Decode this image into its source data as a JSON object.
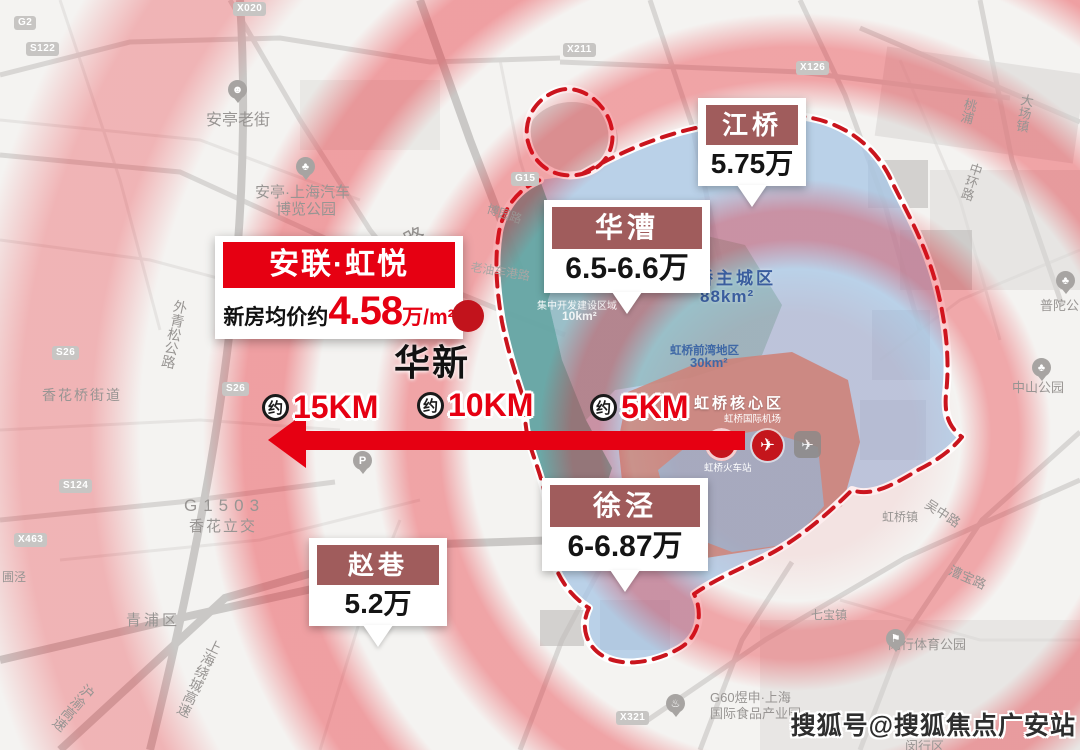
{
  "project_callout": {
    "name": "安联·虹悦",
    "price_prefix": "新房均价约",
    "price_value": "4.58",
    "price_unit": "万/m²",
    "town_label": "华新"
  },
  "area_callouts": [
    {
      "name": "江桥",
      "price": "5.75万"
    },
    {
      "name": "华漕",
      "price": "6.5-6.6万"
    },
    {
      "name": "徐泾",
      "price": "6-6.87万"
    },
    {
      "name": "赵巷",
      "price": "5.2万"
    }
  ],
  "distance_markers": [
    {
      "prefix": "约",
      "distance": "15KM"
    },
    {
      "prefix": "约",
      "distance": "10KM"
    },
    {
      "prefix": "约",
      "distance": "5KM"
    }
  ],
  "planning_regions": {
    "main_city": {
      "name": "虹桥主城区",
      "area": "88km²"
    },
    "front_bay": {
      "name": "虹桥前湾地区",
      "area": "30km²"
    },
    "core": {
      "name": "虹桥核心区"
    },
    "dev_zone": {
      "name": "集中开发建设区域",
      "area": "10km²"
    },
    "airport": {
      "name": "虹桥国际机场"
    },
    "railway_station": {
      "name": "虹桥火车站"
    }
  },
  "map_labels": [
    {
      "text": "花安路"
    },
    {
      "text": "安亭老街"
    },
    {
      "text": "安亭·上海汽车"
    },
    {
      "text": "博览公园"
    },
    {
      "text": "博园路"
    },
    {
      "text": "老油车港路"
    },
    {
      "text": "外青松公路"
    },
    {
      "text": "香花桥街道"
    },
    {
      "text": "G1503"
    },
    {
      "text": "香花立交"
    },
    {
      "text": "青浦区"
    },
    {
      "text": "上海绕城高速"
    },
    {
      "text": "沪渝高速"
    },
    {
      "text": "圃泾"
    },
    {
      "text": "桃浦"
    },
    {
      "text": "大场镇"
    },
    {
      "text": "中环路"
    },
    {
      "text": "普陀公园"
    },
    {
      "text": "中山公园"
    },
    {
      "text": "吴中路"
    },
    {
      "text": "漕宝路"
    },
    {
      "text": "虹桥镇"
    },
    {
      "text": "七宝镇"
    },
    {
      "text": "闵行体育公园"
    },
    {
      "text": "G60煜申·上海"
    },
    {
      "text": "国际食品产业园"
    },
    {
      "text": "闵行区"
    }
  ],
  "road_badges": [
    {
      "code": "X020"
    },
    {
      "code": "G2"
    },
    {
      "code": "S122"
    },
    {
      "code": "X211"
    },
    {
      "code": "X126"
    },
    {
      "code": "G15"
    },
    {
      "code": "S26"
    },
    {
      "code": "S26"
    },
    {
      "code": "S124"
    },
    {
      "code": "X463"
    },
    {
      "code": "X321"
    }
  ],
  "watermark": "搜狐号@搜狐焦点广安站",
  "colors": {
    "accent_red": "#e60012",
    "callout_maroon": "#a05c5c",
    "main_city_blue": "#a9c6e6",
    "dev_zone_teal": "#5da19b",
    "core_pink": "#cc8b81",
    "region_text_blue": "#3a5d9e"
  }
}
